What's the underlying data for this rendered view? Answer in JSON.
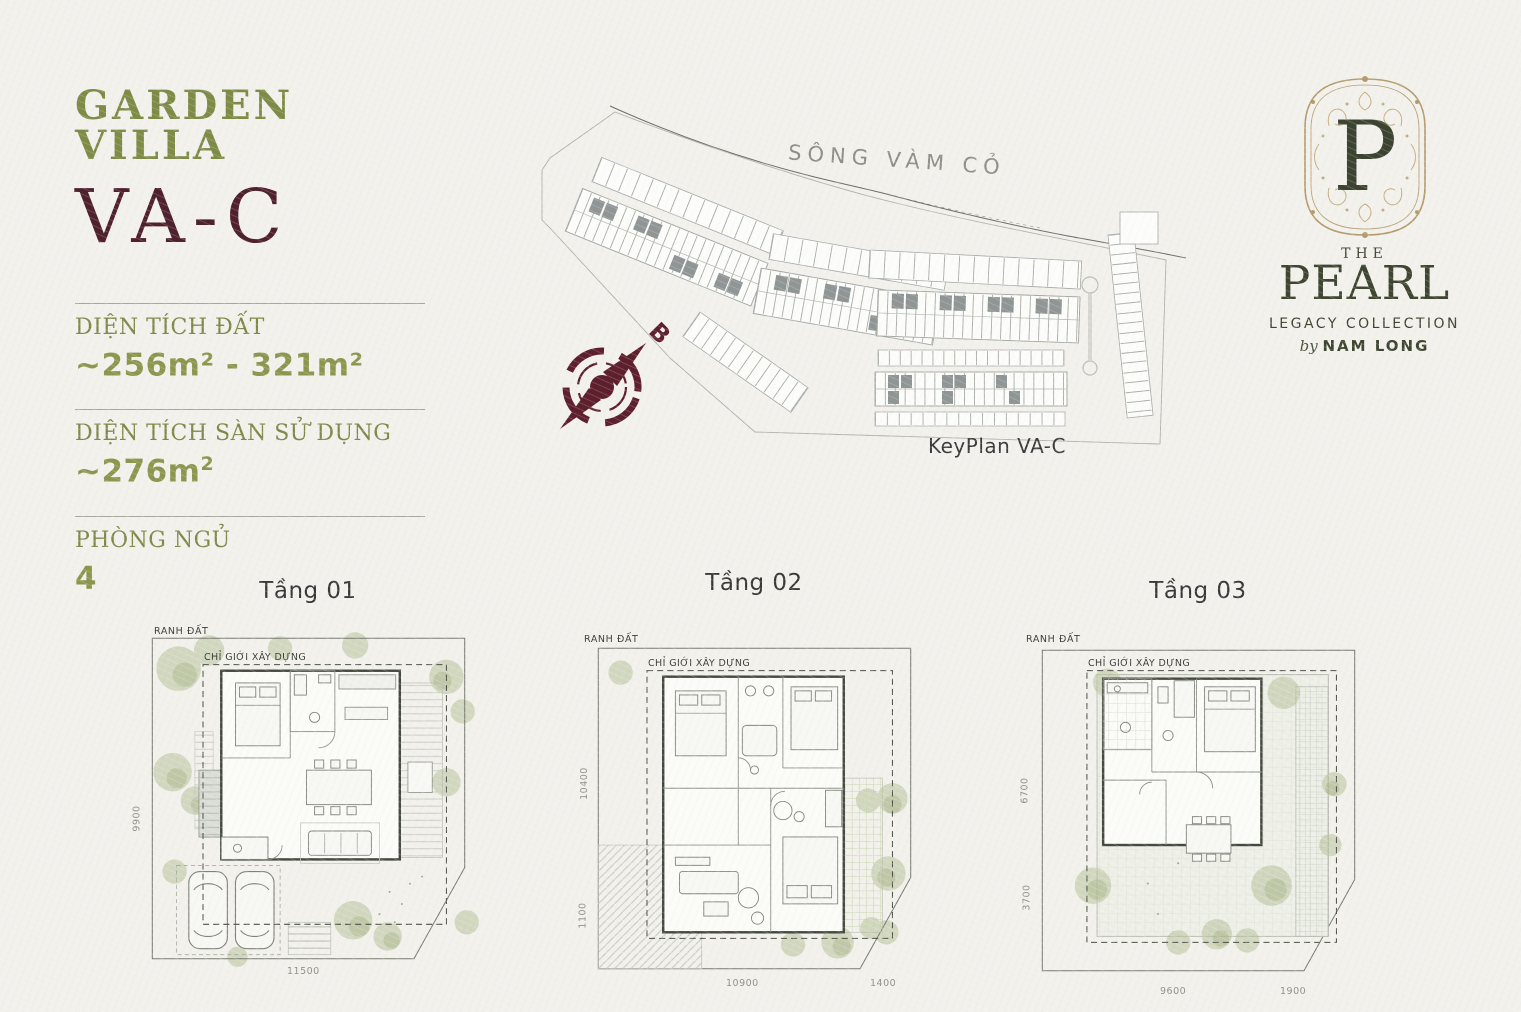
{
  "header": {
    "title": "GARDEN VILLA",
    "code": "VA-C"
  },
  "specs": [
    {
      "label": "DIỆN TÍCH ĐẤT",
      "value": "~256m² - 321m²",
      "sup": ""
    },
    {
      "label": "DIỆN TÍCH SÀN SỬ DỤNG",
      "value": "~276m",
      "sup": "2"
    },
    {
      "label": "PHÒNG NGỦ",
      "value": "4",
      "sup": ""
    }
  ],
  "keyplan": {
    "river_label": "SÔNG VÀM CỎ",
    "caption": "KeyPlan VA-C",
    "compass_letter": "B"
  },
  "logo": {
    "monogram": "P",
    "the": "THE",
    "name": "PEARL",
    "collection": "LEGACY COLLECTION",
    "by": "by",
    "brand": "NAM LONG"
  },
  "floors": [
    {
      "title": "Tầng 01",
      "boundary_label": "RANH ĐẤT",
      "building_line_label": "CHỈ GIỚI XÂY DỰNG",
      "dims": {
        "left1": "9900",
        "bottom1": "11500"
      }
    },
    {
      "title": "Tầng 02",
      "boundary_label": "RANH ĐẤT",
      "building_line_label": "CHỈ GIỚI XÂY DỰNG",
      "dims": {
        "left1": "10400",
        "left2": "1100",
        "bottom1": "10900",
        "bottom2": "1400"
      }
    },
    {
      "title": "Tầng 03",
      "boundary_label": "RANH ĐẤT",
      "building_line_label": "CHỈ GIỚI XÂY DỰNG",
      "dims": {
        "left1": "6700",
        "left2": "3700",
        "bottom1": "9600",
        "bottom2": "1900"
      }
    }
  ],
  "colors": {
    "olive": "#7e8b47",
    "olive_bold": "#8b974e",
    "maroon": "#4f202d",
    "logo_green": "#3e4531",
    "gold": "#b59b6d",
    "ink": "#3a3a3a"
  }
}
